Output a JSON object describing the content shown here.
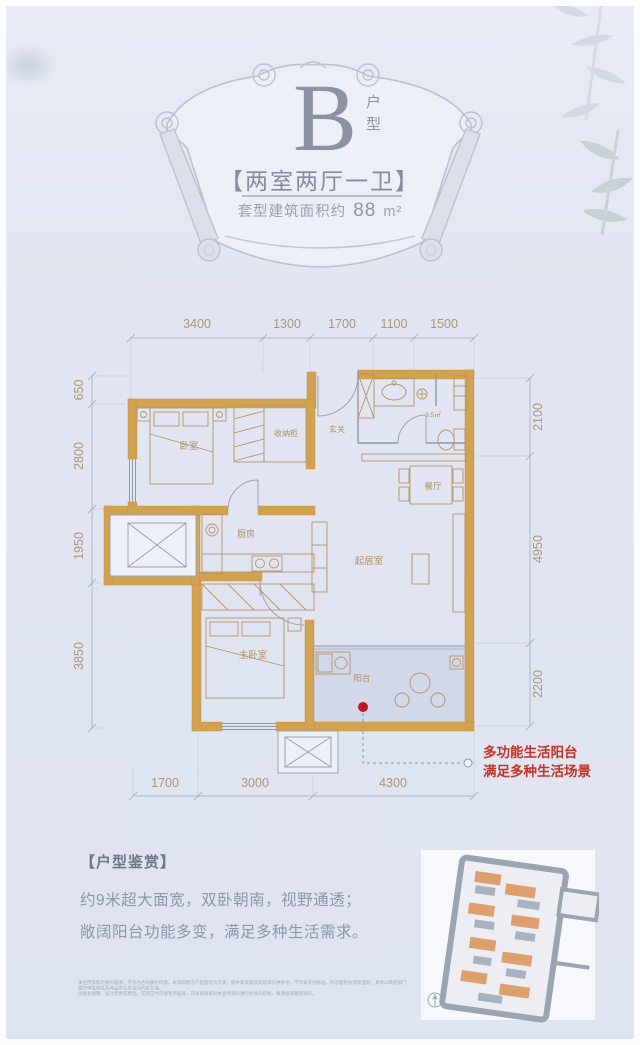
{
  "header": {
    "type_letter": "B",
    "type_suffix": "户型",
    "rooms_title": "【两室两厅一卫】",
    "area_prefix": "套型建筑面积约",
    "area_value": "88",
    "area_unit": "m²"
  },
  "floor_plan": {
    "dims_top": [
      "3400",
      "1300",
      "1700",
      "1100",
      "1500"
    ],
    "dims_left": [
      "650",
      "2800",
      "1950",
      "3850"
    ],
    "dims_right": [
      "2100",
      "4950",
      "2200"
    ],
    "dims_bottom": [
      "1700",
      "3000",
      "4300"
    ],
    "rooms": {
      "bedroom": "卧室",
      "storage": "收纳柜",
      "entry": "玄关",
      "bath_area": "3.5㎡",
      "dining": "餐厅",
      "kitchen": "厨房",
      "living": "起居室",
      "master": "主卧室",
      "balcony": "阳台"
    },
    "annotation": {
      "line1": "多功能生活阳台",
      "line2": "满足多种生活场景"
    }
  },
  "appreciation": {
    "title": "【户型鉴赏】",
    "line1": "约9米超大面宽，双卧朝南，视野通透；",
    "line2": "敞阔阳台功能多变，满足多种生活需求。"
  },
  "disclaimer": {
    "line1": "本宣传资料为要约邀请，不作为合同要约内容。本资料所示户型图仅为示意，图中家具摆设及装饰仅供参考，不代表交付标准。所示面积为建筑面积，具体以政府部门最终审批图纸及商品房买卖合同约定为准。",
    "line2": "因规划调整、设计变更等原因，实际交付可能有所差异，开发商保留对本宣传资料进行修改的权利，敬请留意最新资料。"
  },
  "colors": {
    "background": "#e2e6f2",
    "wall_gold": "#d3a251",
    "dim_text": "#ab9577",
    "annotation_red": "#c43326",
    "header_gray": "#8d94a4",
    "balcony_shade": "#c7cfe2"
  }
}
